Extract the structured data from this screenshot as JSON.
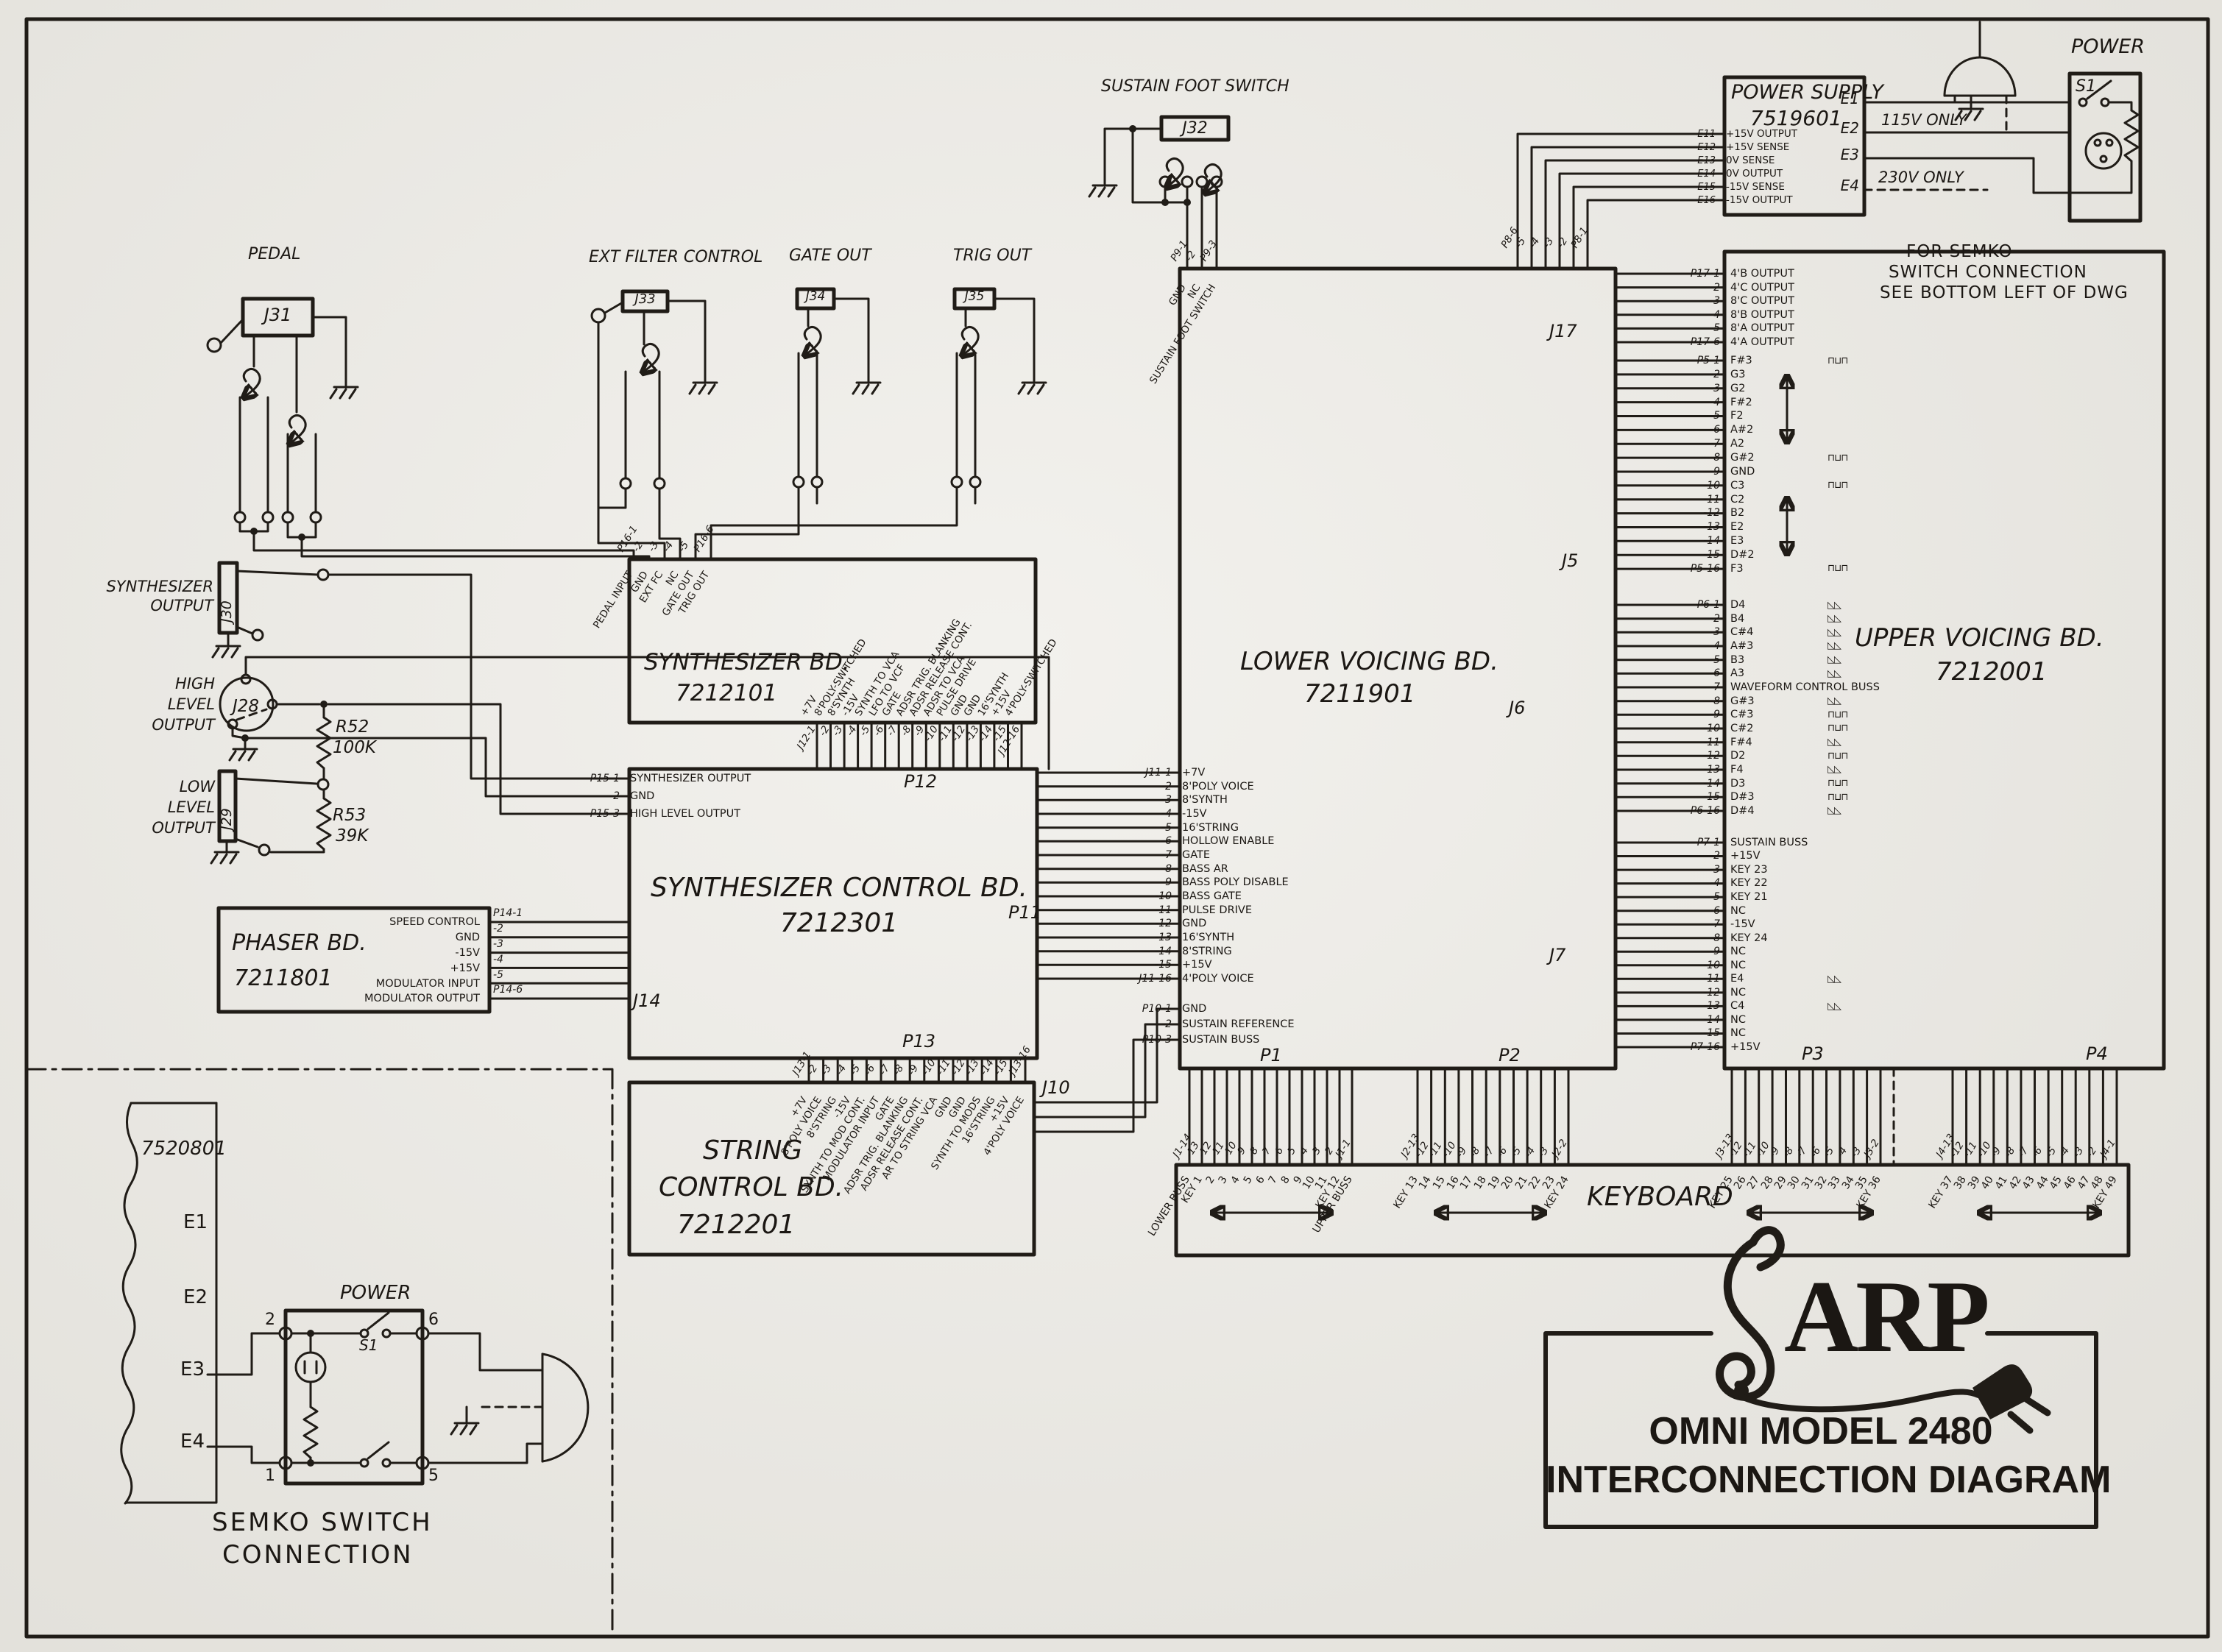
{
  "sheet": {
    "brand": "ARP",
    "title_line1": "OMNI MODEL 2480",
    "title_line2": "INTERCONNECTION DIAGRAM"
  },
  "jacks": {
    "pedal": {
      "label": "PEDAL",
      "ref": "J31"
    },
    "ext_filter": {
      "label": "EXT FILTER CONTROL",
      "ref": "J33"
    },
    "gate_out": {
      "label": "GATE OUT",
      "ref": "J34"
    },
    "trig_out": {
      "label": "TRIG OUT",
      "ref": "J35"
    },
    "sustain_foot_switch": {
      "label": "SUSTAIN FOOT SWITCH",
      "ref": "J32"
    },
    "synth_output": {
      "line1": "SYNTHESIZER",
      "line2": "OUTPUT",
      "ref": "J30"
    },
    "high_level_output": {
      "line1": "HIGH",
      "line2": "LEVEL",
      "line3": "OUTPUT",
      "ref": "J28"
    },
    "low_level_output": {
      "line1": "LOW",
      "line2": "LEVEL",
      "line3": "OUTPUT",
      "ref": "J29"
    }
  },
  "resistors": {
    "r52": {
      "ref": "R52",
      "value": "100K"
    },
    "r53": {
      "ref": "R53",
      "value": "39K"
    }
  },
  "power_supply": {
    "name": "POWER SUPPLY",
    "number": "7519601",
    "ports": [
      {
        "e": "E11",
        "label": "+15V OUTPUT"
      },
      {
        "e": "E12",
        "label": "+15V SENSE"
      },
      {
        "e": "E13",
        "label": "0V SENSE"
      },
      {
        "e": "E14",
        "label": "0V OUTPUT"
      },
      {
        "e": "E15",
        "label": "-15V SENSE"
      },
      {
        "e": "E16",
        "label": "-15V OUTPUT"
      }
    ],
    "term_e1": "E1",
    "term_e2": "E2",
    "term_e3": "E3",
    "term_e4": "E4",
    "note_115": "115V ONLY",
    "note_230": "230V ONLY",
    "semko_note1": "FOR SEMKO",
    "semko_note2": "SWITCH CONNECTION",
    "semko_note3": "SEE BOTTOM LEFT OF DWG",
    "power_label": "POWER",
    "switch_ref": "S1"
  },
  "boards": {
    "synth": {
      "name": "SYNTHESIZER BD.",
      "number": "7212101",
      "p16": [
        {
          "n": "P16-1",
          "label": "PEDAL INPUT"
        },
        {
          "n": "-2",
          "label": "GND"
        },
        {
          "n": "-3",
          "label": "EXT FC"
        },
        {
          "n": "-4",
          "label": "NC"
        },
        {
          "n": "-5",
          "label": "GATE OUT"
        },
        {
          "n": "P16-6",
          "label": "TRIG OUT"
        }
      ],
      "j12": [
        {
          "n": "J12-1",
          "label": "+7V"
        },
        {
          "n": "-2",
          "label": "8'POLY-SWITCHED"
        },
        {
          "n": "-3",
          "label": "8'SYNTH"
        },
        {
          "n": "-4",
          "label": "-15V"
        },
        {
          "n": "-5",
          "label": "SYNTH TO VCA"
        },
        {
          "n": "-6",
          "label": "LFO TO VCF"
        },
        {
          "n": "-7",
          "label": "GATE"
        },
        {
          "n": "-8",
          "label": "ADSR TRIG. BLANKING"
        },
        {
          "n": "-9",
          "label": "ADSR RELEASE CONT."
        },
        {
          "n": "-10",
          "label": "ADSR TO VCA"
        },
        {
          "n": "-11",
          "label": "PULSE DRIVE"
        },
        {
          "n": "-12",
          "label": "GND"
        },
        {
          "n": "-13",
          "label": "GND"
        },
        {
          "n": "-14",
          "label": "16'SYNTH"
        },
        {
          "n": "-15",
          "label": "+15V"
        },
        {
          "n": "J12-16",
          "label": "4'POLY-SWITCHED"
        }
      ]
    },
    "synth_control": {
      "name": "SYNTHESIZER CONTROL BD.",
      "number": "7212301",
      "p12": "P12",
      "p11": "P11",
      "j14": "J14",
      "p13": "P13",
      "p15": [
        {
          "n": "P15-1",
          "label": "SYNTHESIZER OUTPUT"
        },
        {
          "n": "-2",
          "label": "GND"
        },
        {
          "n": "P15-3",
          "label": "HIGH LEVEL OUTPUT"
        }
      ]
    },
    "string_control": {
      "name1": "STRING",
      "name2": "CONTROL BD.",
      "number": "7212201",
      "j10": "J10",
      "j13": [
        {
          "n": "J13-1",
          "label": "+7V"
        },
        {
          "n": "-2",
          "label": "8'POLY VOICE"
        },
        {
          "n": "-3",
          "label": "8'STRING"
        },
        {
          "n": "-4",
          "label": "-15V"
        },
        {
          "n": "-5",
          "label": "SYNTH TO MOD CONT."
        },
        {
          "n": "-6",
          "label": "MODULATOR INPUT"
        },
        {
          "n": "-7",
          "label": "GATE"
        },
        {
          "n": "-8",
          "label": "ADSR TRIG. BLANKING"
        },
        {
          "n": "-9",
          "label": "ADSR RELEASE CONT."
        },
        {
          "n": "-10",
          "label": "AR TO STRING VCA"
        },
        {
          "n": "-11",
          "label": "GND"
        },
        {
          "n": "-12",
          "label": "GND"
        },
        {
          "n": "-13",
          "label": "SYNTH TO MODS"
        },
        {
          "n": "-14",
          "label": "16'STRING"
        },
        {
          "n": "-15",
          "label": "+15V"
        },
        {
          "n": "J13-16",
          "label": "4'POLY VOICE"
        }
      ]
    },
    "phaser": {
      "name": "PHASER BD.",
      "number": "7211801",
      "p14": [
        {
          "n": "P14-1",
          "label": "SPEED CONTROL"
        },
        {
          "n": "-2",
          "label": "GND"
        },
        {
          "n": "-3",
          "label": "-15V"
        },
        {
          "n": "-4",
          "label": "+15V"
        },
        {
          "n": "-5",
          "label": "MODULATOR INPUT"
        },
        {
          "n": "P14-6",
          "label": "MODULATOR OUTPUT"
        }
      ]
    },
    "lower": {
      "name": "LOWER VOICING BD.",
      "number": "7211901",
      "j17": "J17",
      "j5": "J5",
      "j6": "J6",
      "j7": "J7",
      "p1": "P1",
      "p2": "P2",
      "p9": [
        {
          "n": "P9-1",
          "label": "GND"
        },
        {
          "n": "-2",
          "label": "NC"
        },
        {
          "n": "P9-3",
          "label": "SUSTAIN FOOT SWITCH"
        }
      ],
      "p8": [
        "P8-6",
        "-5",
        "-4",
        "-3",
        "-2",
        "P8-1"
      ],
      "j11": [
        {
          "n": "J11-1",
          "label": "+7V"
        },
        {
          "n": "-2",
          "label": "8'POLY VOICE"
        },
        {
          "n": "-3",
          "label": "8'SYNTH"
        },
        {
          "n": "-4",
          "label": "-15V"
        },
        {
          "n": "-5",
          "label": "16'STRING"
        },
        {
          "n": "-6",
          "label": "HOLLOW ENABLE"
        },
        {
          "n": "-7",
          "label": "GATE"
        },
        {
          "n": "-8",
          "label": "BASS AR"
        },
        {
          "n": "-9",
          "label": "BASS POLY DISABLE"
        },
        {
          "n": "-10",
          "label": "BASS GATE"
        },
        {
          "n": "-11",
          "label": "PULSE DRIVE"
        },
        {
          "n": "-12",
          "label": "GND"
        },
        {
          "n": "-13",
          "label": "16'SYNTH"
        },
        {
          "n": "-14",
          "label": "8'STRING"
        },
        {
          "n": "-15",
          "label": "+15V"
        },
        {
          "n": "J11-16",
          "label": "4'POLY VOICE"
        }
      ],
      "p10": [
        {
          "n": "P10-1",
          "label": "GND"
        },
        {
          "n": "-2",
          "label": "SUSTAIN REFERENCE"
        },
        {
          "n": "P10-3",
          "label": "SUSTAIN BUSS"
        }
      ]
    },
    "upper": {
      "name": "UPPER VOICING BD.",
      "number": "7212001",
      "p3": "P3",
      "p4": "P4",
      "p17": [
        {
          "n": "P17-1",
          "label": "4'B OUTPUT"
        },
        {
          "n": "-2",
          "label": "4'C OUTPUT"
        },
        {
          "n": "-3",
          "label": "8'C OUTPUT"
        },
        {
          "n": "-4",
          "label": "8'B OUTPUT"
        },
        {
          "n": "-5",
          "label": "8'A OUTPUT"
        },
        {
          "n": "P17-6",
          "label": "4'A OUTPUT"
        }
      ],
      "p5": [
        {
          "n": "P5-1",
          "label": "F#3",
          "w": "⊓⊔⊓"
        },
        {
          "n": "-2",
          "label": "G3"
        },
        {
          "n": "-3",
          "label": "G2"
        },
        {
          "n": "-4",
          "label": "F#2"
        },
        {
          "n": "-5",
          "label": "F2"
        },
        {
          "n": "-6",
          "label": "A#2"
        },
        {
          "n": "-7",
          "label": "A2"
        },
        {
          "n": "-8",
          "label": "G#2",
          "w": "⊓⊔⊓"
        },
        {
          "n": "-9",
          "label": "GND"
        },
        {
          "n": "-10",
          "label": "C3",
          "w": "⊓⊔⊓"
        },
        {
          "n": "-11",
          "label": "C2"
        },
        {
          "n": "-12",
          "label": "B2"
        },
        {
          "n": "-13",
          "label": "E2"
        },
        {
          "n": "-14",
          "label": "E3"
        },
        {
          "n": "-15",
          "label": "D#2"
        },
        {
          "n": "P5-16",
          "label": "F3",
          "w": "⊓⊔⊓"
        }
      ],
      "p6": [
        {
          "n": "P6-1",
          "label": "D4",
          "w": "◺◺"
        },
        {
          "n": "-2",
          "label": "B4",
          "w": "◺◺"
        },
        {
          "n": "-3",
          "label": "C#4",
          "w": "◺◺"
        },
        {
          "n": "-4",
          "label": "A#3",
          "w": "◺◺"
        },
        {
          "n": "-5",
          "label": "B3",
          "w": "◺◺"
        },
        {
          "n": "-6",
          "label": "A3",
          "w": "◺◺"
        },
        {
          "n": "-7",
          "label": "WAVEFORM CONTROL BUSS"
        },
        {
          "n": "-8",
          "label": "G#3",
          "w": "◺◺"
        },
        {
          "n": "-9",
          "label": "C#3",
          "w": "⊓⊔⊓"
        },
        {
          "n": "-10",
          "label": "C#2",
          "w": "⊓⊔⊓"
        },
        {
          "n": "-11",
          "label": "F#4",
          "w": "◺◺"
        },
        {
          "n": "-12",
          "label": "D2",
          "w": "⊓⊔⊓"
        },
        {
          "n": "-13",
          "label": "F4",
          "w": "◺◺"
        },
        {
          "n": "-14",
          "label": "D3",
          "w": "⊓⊔⊓"
        },
        {
          "n": "-15",
          "label": "D#3",
          "w": "⊓⊔⊓"
        },
        {
          "n": "P6-16",
          "label": "D#4",
          "w": "◺◺"
        }
      ],
      "p7": [
        {
          "n": "P7-1",
          "label": "SUSTAIN BUSS"
        },
        {
          "n": "-2",
          "label": "+15V"
        },
        {
          "n": "-3",
          "label": "KEY 23"
        },
        {
          "n": "-4",
          "label": "KEY 22"
        },
        {
          "n": "-5",
          "label": "KEY 21"
        },
        {
          "n": "-6",
          "label": "NC"
        },
        {
          "n": "-7",
          "label": "-15V"
        },
        {
          "n": "-8",
          "label": "KEY 24"
        },
        {
          "n": "-9",
          "label": "NC"
        },
        {
          "n": "-10",
          "label": "NC"
        },
        {
          "n": "-11",
          "label": "E4",
          "w": "◺◺"
        },
        {
          "n": "-12",
          "label": "NC"
        },
        {
          "n": "-13",
          "label": "C4",
          "w": "◺◺"
        },
        {
          "n": "-14",
          "label": "NC"
        },
        {
          "n": "-15",
          "label": "NC"
        },
        {
          "n": "P7-16",
          "label": "+15V"
        }
      ]
    }
  },
  "keyboard": {
    "label": "KEYBOARD",
    "p1": "P1",
    "p2": "P2",
    "p3": "P3",
    "p4": "P4",
    "j1_pins": [
      "J1-14",
      "-13",
      "-12",
      "-11",
      "-10",
      "-9",
      "-8",
      "-7",
      "-6",
      "-5",
      "-4",
      "-3",
      "-2",
      "J1-1"
    ],
    "j1_keys": [
      "LOWER BUSS",
      "KEY 1",
      "2",
      "3",
      "4",
      "5",
      "6",
      "7",
      "8",
      "9",
      "10",
      "11",
      "KEY 12",
      "UPPER BUSS"
    ],
    "j2_pins": [
      "J2-13",
      "-12",
      "-11",
      "-10",
      "-9",
      "-8",
      "-7",
      "-6",
      "-5",
      "-4",
      "-3",
      "J2-2"
    ],
    "j2_keys": [
      "KEY 13",
      "14",
      "15",
      "16",
      "17",
      "18",
      "19",
      "20",
      "21",
      "22",
      "23",
      "KEY 24"
    ],
    "j3_pins": [
      "J3-13",
      "-12",
      "-11",
      "-10",
      "-9",
      "-8",
      "-7",
      "-6",
      "-5",
      "-4",
      "-3",
      "J3-2"
    ],
    "j3_keys": [
      "KEY 25",
      "26",
      "27",
      "28",
      "29",
      "30",
      "31",
      "32",
      "33",
      "34",
      "35",
      "KEY 36"
    ],
    "j4_pins": [
      "J4-13",
      "-12",
      "-11",
      "-10",
      "-9",
      "-8",
      "-7",
      "-6",
      "-5",
      "-4",
      "-3",
      "-2",
      "J4-1"
    ],
    "j4_keys": [
      "KEY 37",
      "38",
      "39",
      "40",
      "41",
      "42",
      "43",
      "44",
      "45",
      "46",
      "47",
      "48",
      "KEY 49"
    ]
  },
  "semko": {
    "board_number": "7520801",
    "e1": "E1",
    "e2": "E2",
    "e3": "E3",
    "e4": "E4",
    "power_label": "POWER",
    "switch_ref": "S1",
    "pin2": "2",
    "pin6": "6",
    "pin1": "1",
    "pin5": "5",
    "caption1": "SEMKO SWITCH",
    "caption2": "CONNECTION"
  }
}
